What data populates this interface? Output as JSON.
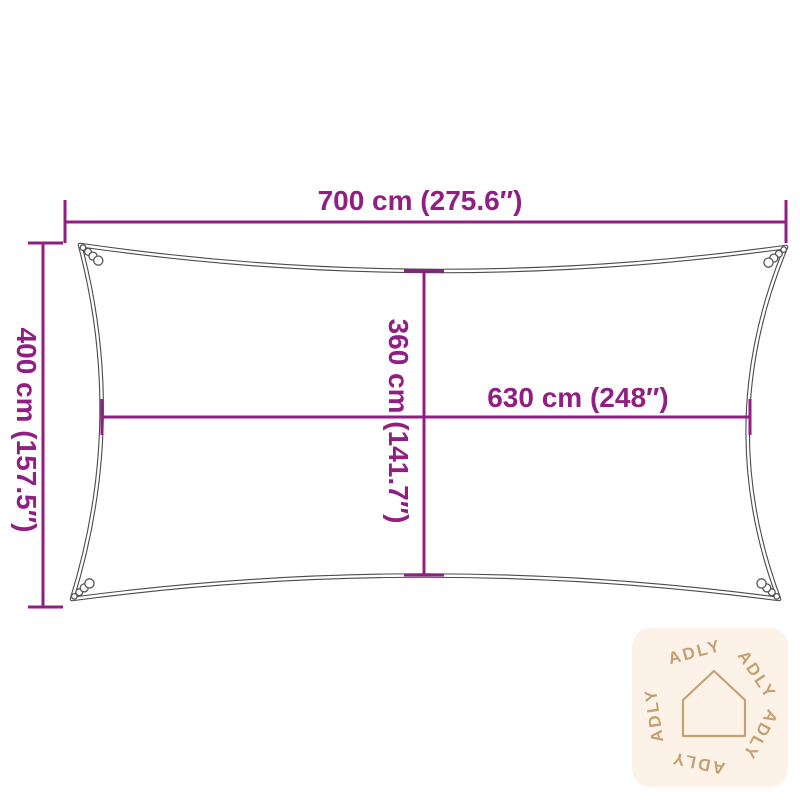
{
  "diagram": {
    "subject": "rectangular-shade-sail-dimension-diagram",
    "dimensions": {
      "width_top": "700 cm (275.6″)",
      "height_left": "400 cm (157.5″)",
      "height_inner": "360 cm (141.7″)",
      "width_inner": "630 cm (248″)"
    },
    "colors": {
      "dimension_line": "#911e82",
      "sail_outline": "#4a4a4a",
      "watermark_badge_bg": "#fdf2e8",
      "watermark_accent": "#c5a172"
    },
    "watermark": {
      "brand": "ADLY",
      "icon": "house-outline-icon",
      "words": [
        "ADLY",
        "ADLY",
        "ADLY",
        "ADLY",
        "ADLY"
      ]
    }
  }
}
